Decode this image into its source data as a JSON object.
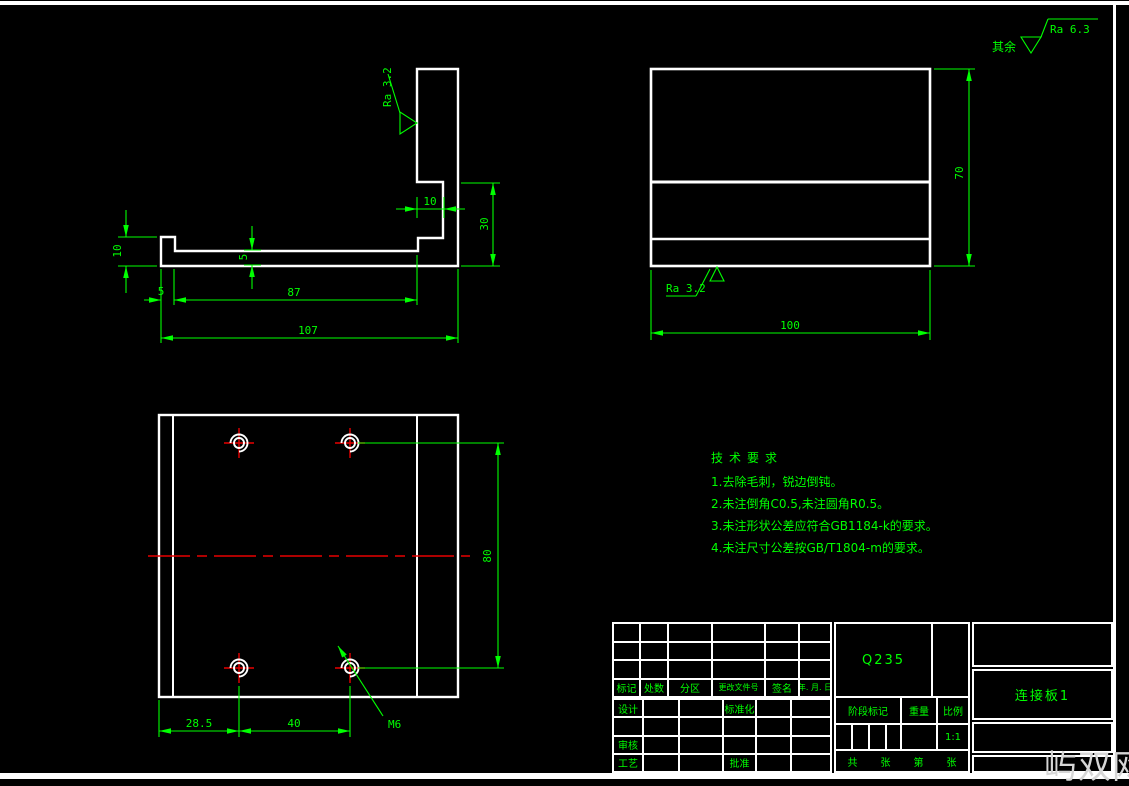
{
  "surface": {
    "general_label": "其余",
    "general_value": "Ra 6.3",
    "local": "Ra 3.2"
  },
  "dims": {
    "side": {
      "total_length": "107",
      "web_length": "87",
      "lip_width": "5",
      "lip_height": "10",
      "web_thickness": "5",
      "notch_width": "10",
      "flange_drop": "30"
    },
    "front": {
      "width": "100",
      "height": "70"
    },
    "top": {
      "edge_to_hole": "28.5",
      "hole_spacing_x": "40",
      "hole_spacing_y": "80",
      "thread": "M6"
    }
  },
  "tech": {
    "title": "技术要求",
    "lines": [
      "1.去除毛刺，锐边倒钝。",
      "2.未注倒角C0.5,未注圆角R0.5。",
      "3.未注形状公差应符合GB1184-k的要求。",
      "4.未注尺寸公差按GB/T1804-m的要求。"
    ]
  },
  "title_block": {
    "material": "Q235",
    "part_name": "连接板1",
    "scale_value": "1:1",
    "rev_headers": [
      "标记",
      "处数",
      "分区",
      "更改文件号",
      "签名",
      "年. 月. 日"
    ],
    "labels": {
      "design": "设计",
      "standardize": "标准化",
      "review": "审核",
      "process": "工艺",
      "approve": "批准",
      "stage": "阶段标记",
      "weight": "重量",
      "scale": "比例"
    },
    "sheet": {
      "total": "共",
      "unit": "张",
      "page": "第",
      "unit2": "张"
    }
  },
  "watermark": "屿双网",
  "colors": {
    "line": "#ffffff",
    "dimension": "#00ff00",
    "centerline": "#e80000",
    "background": "#000000",
    "watermark": "#d6d6d6"
  }
}
